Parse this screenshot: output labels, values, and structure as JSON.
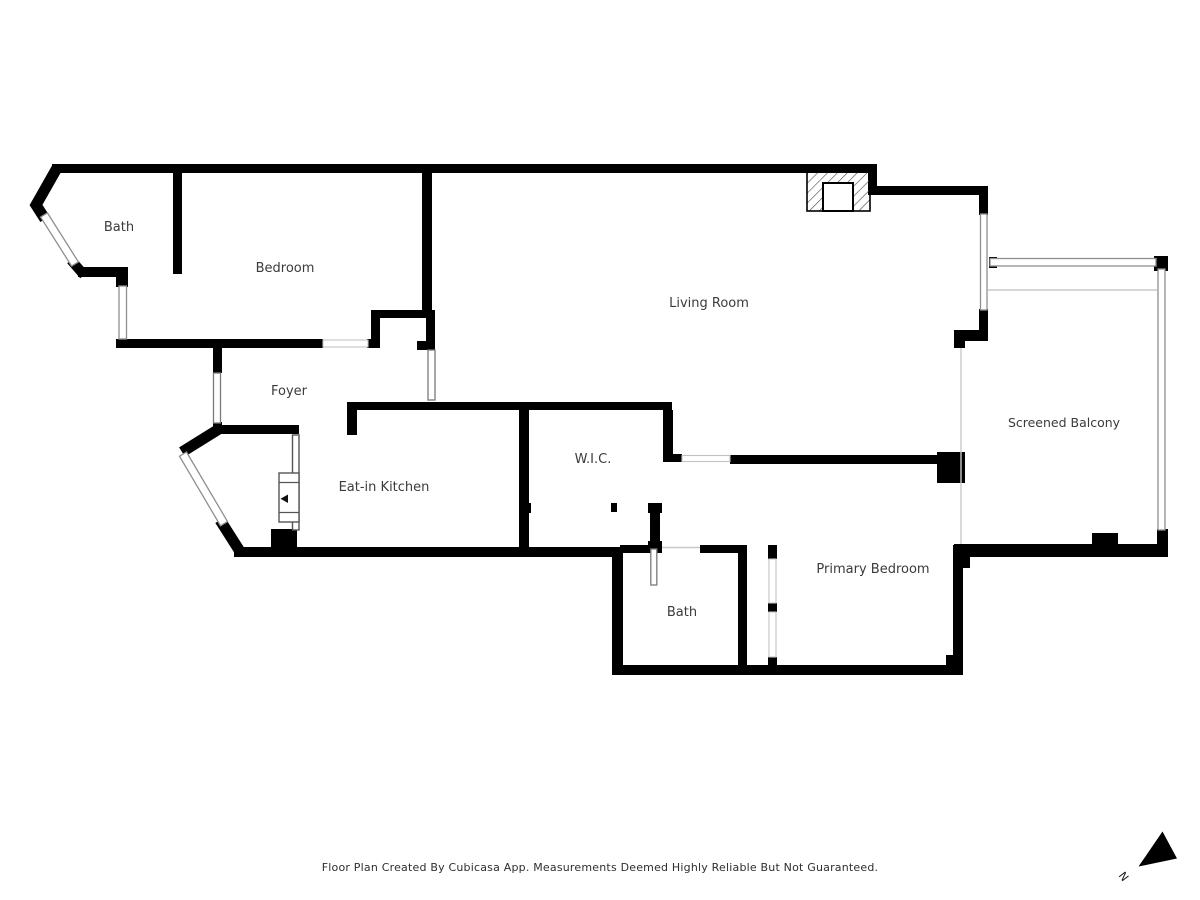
{
  "rooms": [
    {
      "id": "bath-upper",
      "label": "Bath"
    },
    {
      "id": "bedroom",
      "label": "Bedroom"
    },
    {
      "id": "living-room",
      "label": "Living Room"
    },
    {
      "id": "foyer",
      "label": "Foyer"
    },
    {
      "id": "eat-in-kitchen",
      "label": "Eat-in Kitchen"
    },
    {
      "id": "wic",
      "label": "W.I.C."
    },
    {
      "id": "screened-balcony",
      "label": "Screened Balcony"
    },
    {
      "id": "bath-lower",
      "label": "Bath"
    },
    {
      "id": "primary-bedroom",
      "label": "Primary Bedroom"
    }
  ],
  "compass": {
    "label": "N"
  },
  "footer": {
    "disclaimer": "Floor Plan Created By Cubicasa App. Measurements Deemed Highly Reliable But Not Guaranteed."
  },
  "colors": {
    "background": "#ffffff",
    "wall": "#000000",
    "window_stroke": "#8f8f8f",
    "opening_stroke": "#c2c2c2",
    "door_stroke": "#7a7a7a",
    "thin_line": "#c9c9c9",
    "label_text": "#3b3b3b",
    "footer_text": "#2e2e2e"
  }
}
